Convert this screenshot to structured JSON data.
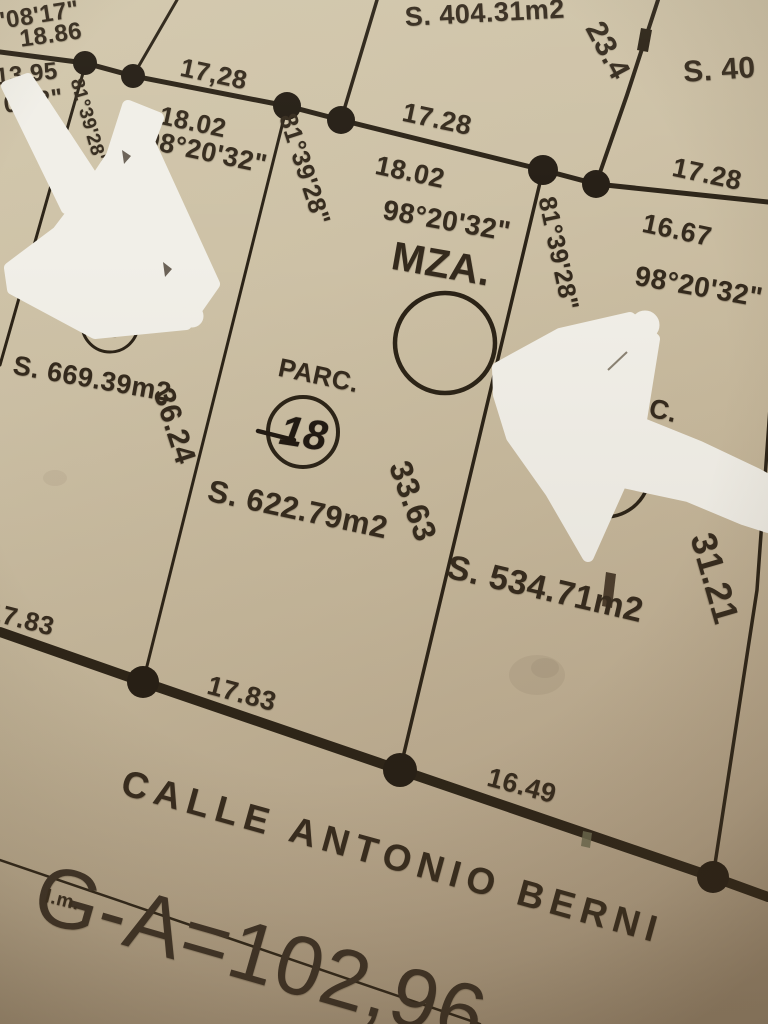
{
  "corner_labels": {
    "angle_top_left": "'08'17\"",
    "len_top_left": "18.86",
    "len_left": "13.95",
    "angle_left": "0'32\""
  },
  "back_line": {
    "seg1_upper": "17,28",
    "seg1_lower": "18.02",
    "angle1": "98°20'32\"",
    "seg2_upper": "17.28",
    "seg2_lower": "18.02",
    "angle2": "98°20'32\"",
    "seg3_upper": "17.28",
    "seg3_lower": "16.67",
    "angle3": "98°20'32\"",
    "side_upper_right": "23.4"
  },
  "upper_parcels": {
    "area_center": "S. 404.31m2",
    "area_right": "S. 40"
  },
  "block": {
    "label": "MZA."
  },
  "side_angles": {
    "left": "81°39'28\"",
    "mid": "81°39'28\"",
    "right": "81°39'28\""
  },
  "parcel_17": {
    "number": "17",
    "area": "S. 669.39m2",
    "depth": "36.24"
  },
  "parcel_18": {
    "label": "PARC.",
    "number": "18",
    "area": "S. 622.79m2",
    "depth": "33.63"
  },
  "parcel_19": {
    "label": "PARC.",
    "area": "S. 534.71m2",
    "depth": "31.21"
  },
  "street": {
    "front_left": "17.83",
    "front_mid": "17.83",
    "front_right": "16.49",
    "name": "CALLE ANTONIO BERNI",
    "total_measure": "G-A=102,96",
    "lm": "l.m."
  }
}
